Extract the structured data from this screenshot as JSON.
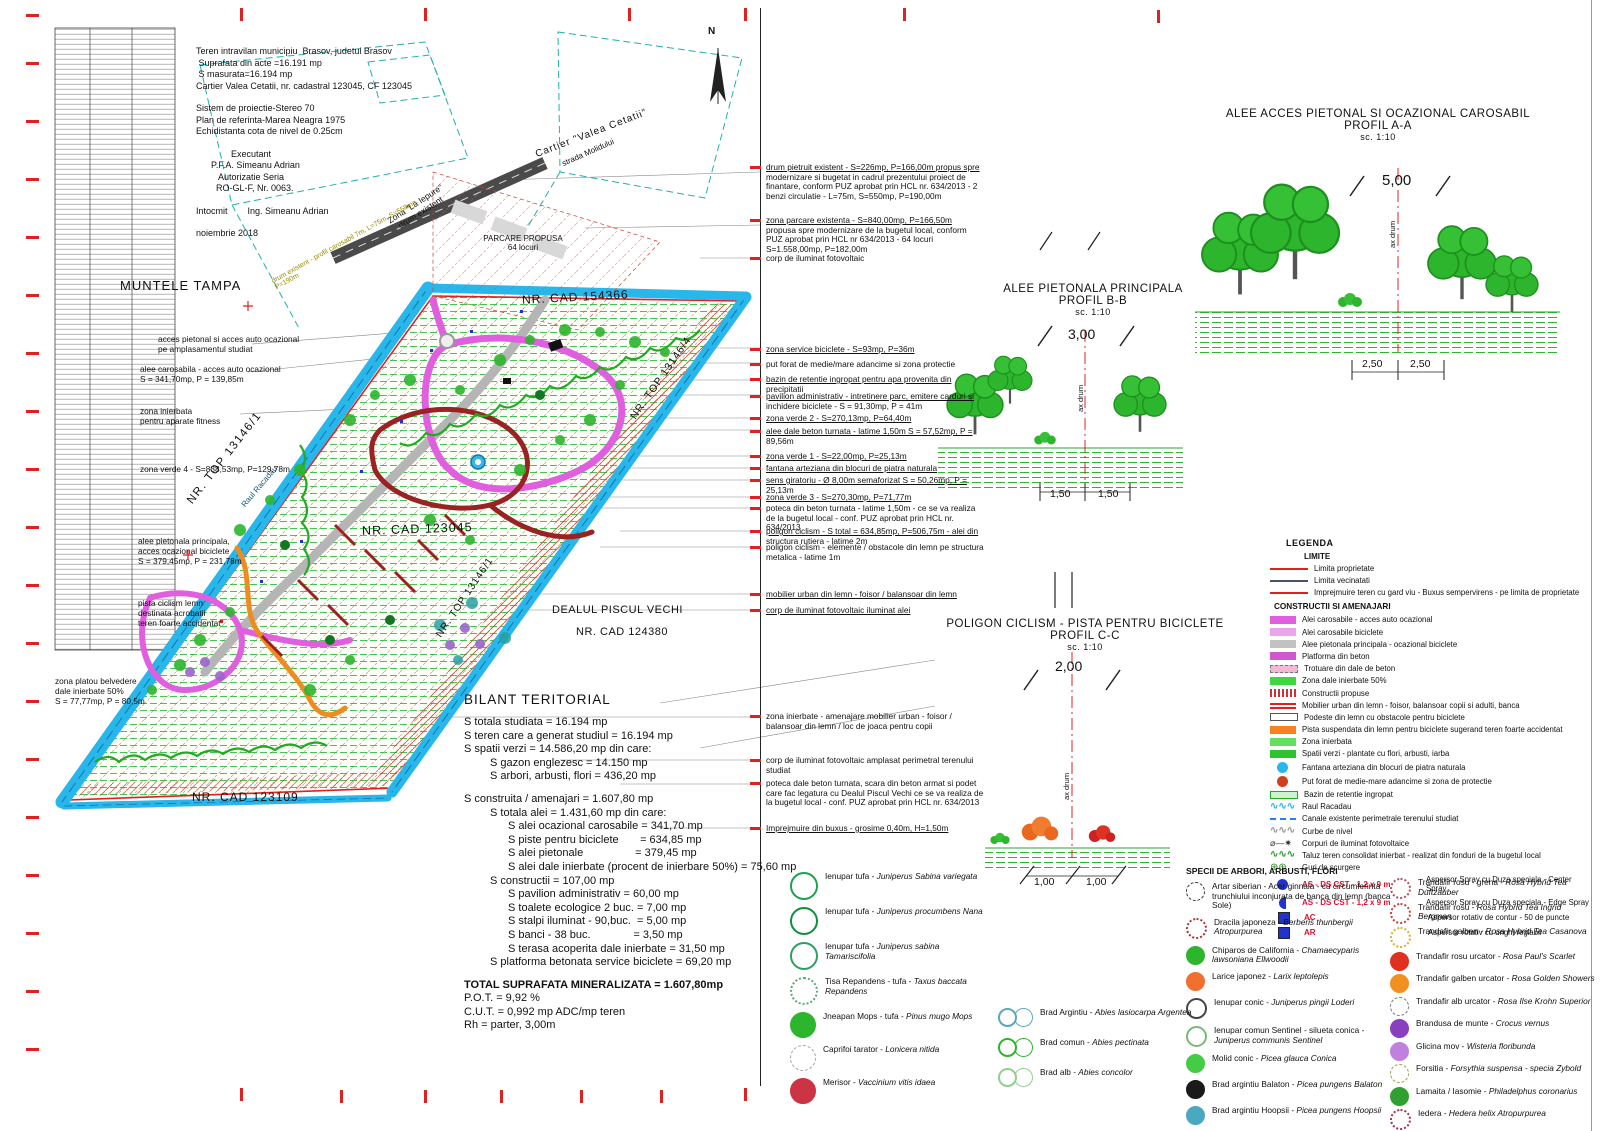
{
  "info_block": {
    "lines": [
      "Teren intravilan municipiu  Brasov, judetul Brasov",
      " Suprafata din acte =16.191 mp",
      " S masurata=16.194 mp",
      "Cartier Valea Cetatii, nr. cadastral 123045, CF 123045",
      "",
      "Sistem de proiectie-Stereo 70",
      "Plan de referinta-Marea Neagra 1975",
      "Echidistanta cota de nivel de 0.25cm",
      "",
      "              Executant",
      "      P.F.A. Simeanu Adrian",
      "         Autorizatie Seria",
      "        RO-GL-F, Nr. 0063.",
      "",
      "Intocmit        Ing. Simeanu Adrian",
      "",
      "noiembrie 2018"
    ]
  },
  "plan_labels": {
    "muntele_tampa": "MUNTELE TAMPA",
    "cartier": "Cartier \"Valea Cetatii\"",
    "strada": "strada Molidului",
    "zona_la_iepure": "Zona \"La Iepure\"\ndrum existent",
    "road_note": "drum existent - profil carosabil 7m, L=75m, S=550mp, P=190m",
    "parcare": "PARCARE PROPUSA\n64 locuri",
    "nr_cad_154366": "NR. CAD 154366",
    "nr_top_13146_4": "NR. TOP 13146/4",
    "nr_top_13146_1a": "NR. TOP 13146/1",
    "nr_top_13146_1b": "NR. TOP 13146/1",
    "nr_cad_123045": "NR. CAD 123045",
    "dealul_piscul_vechi": "DEALUL PISCUL VECHI",
    "nr_cad_124380": "NR. CAD 124380",
    "nr_cad_123109": "NR. CAD 123109",
    "raul_racadau": "Raul Racadau",
    "north": "N"
  },
  "left_labels": [
    {
      "t": "acces pietonal si acces auto ocazional\npe amplasamentul studiat"
    },
    {
      "t": "alee carosabila - acces auto ocazional\nS = 341,70mp, P = 139,85m"
    },
    {
      "t": "zona inierbata\npentru aparate fitness"
    },
    {
      "t": "zona verde 4 - S=838,53mp, P=129,78m"
    },
    {
      "t": "alee pietonala principala,\nacces ocazional biciclete\nS = 379,45mp, P = 231,78m"
    },
    {
      "t": "pista ciclism lemn\ndestinata acrobatii\nteren foarte accidentat"
    },
    {
      "t": "zona platou belvedere\ndale inierbate 50%\nS = 77,77mp, P = 80,5m"
    }
  ],
  "notes": [
    {
      "t": "drum pietruit existent - S=226mp, P=166,00m propus spre modernizare si bugetat in cadrul prezentului proiect de finantare, conform PUZ aprobat prin HCL nr. 634/2013 - 2 benzi circulatie - L=75m, S=550mp, P=190,00m"
    },
    {
      "t": "zona parcare existenta - S=840,00mp, P=166,50m propusa spre modernizare de la bugetul local, conform PUZ aprobat prin HCL nr 634/2013 - 64 locuri S=1.558,00mp, P=182,00m"
    },
    {
      "t": "corp de iluminat fotovoltaic"
    },
    {
      "t": "zona service biciclete - S=93mp, P=36m"
    },
    {
      "t": "put forat de medie/mare adancime si zona protectie"
    },
    {
      "t": "bazin de retentie ingropat pentru apa provenita din precipitatii"
    },
    {
      "t": "pavilion administrativ - intretinere parc, emitere carduri si inchidere biciclete - S = 91,30mp, P = 41m"
    },
    {
      "t": "zona verde 2 - S=270,13mp, P=64,40m"
    },
    {
      "t": "alee dale beton turnata - latime 1,50m S = 57,52mp, P = 89,56m"
    },
    {
      "t": "zona verde 1 - S=22,00mp, P=25,13m"
    },
    {
      "t": "fantana arteziana din blocuri de piatra naturala"
    },
    {
      "t": "sens giratoriu - Ø 8,00m semaforizat S = 50,26mp, P = 25,13m"
    },
    {
      "t": "zona verde 3 - S=270,30mp, P=71,77m"
    },
    {
      "t": "poteca din beton turnata - latime 1,50m - ce se va realiza de la bugetul local - conf. PUZ aprobat prin HCL nr. 634/2013"
    },
    {
      "t": "poligon ciclism - S total = 634,85mp, P=506,75m - alei din structura rutiera - latime 2m"
    },
    {
      "t": "poligon ciclism - elemente / obstacole din lemn pe structura metalica - latime 1m"
    },
    {
      "t": "mobilier urban din lemn - foisor / balansoar din lemn"
    },
    {
      "t": "corp de iluminat fotovoltaic iluminat alei"
    },
    {
      "t": "zona inierbate - amenajare mobilier urban - foisor / balansoar din lemn / loc de joaca pentru copii"
    },
    {
      "t": "corp de iluminat fotovoltaic amplasat perimetral terenului studiat"
    },
    {
      "t": "poteca dale beton turnata, scara din beton armat si podet care fac legatura cu Dealul Piscul Vechi ce se va realiza de la bugetul local - conf. PUZ aprobat prin HCL nr. 634/2013"
    },
    {
      "t": "Imprejmuire din buxus - grosime 0,40m, H=1,50m"
    }
  ],
  "bilant": {
    "title": "BILANT TERITORIAL",
    "lines": [
      {
        "cls": "i0",
        "t": "S totala studiata = 16.194 mp"
      },
      {
        "cls": "i0",
        "t": "S teren care a generat studiul = 16.194 mp"
      },
      {
        "cls": "i0",
        "t": "S spatii verzi = 14.586,20 mp din care:"
      },
      {
        "cls": "i1",
        "t": "S gazon englezesc = 14.150 mp"
      },
      {
        "cls": "i1",
        "t": "S arbori, arbusti, flori = 436,20 mp"
      },
      {
        "cls": "i0 gap",
        "t": "S construita / amenajari = 1.607,80 mp"
      },
      {
        "cls": "i1",
        "t": "S totala alei = 1.431,60 mp din care:"
      },
      {
        "cls": "i2",
        "t": "S alei ocazional carosabile = 341,70 mp"
      },
      {
        "cls": "i2",
        "t": "S piste pentru biciclete       = 634,85 mp"
      },
      {
        "cls": "i2",
        "t": "S alei pietonale                 = 379,45 mp"
      },
      {
        "cls": "i2",
        "t": "S alei dale inierbate (procent de inierbare 50%) = 75,60 mp"
      },
      {
        "cls": "i1",
        "t": "S constructii = 107,00 mp"
      },
      {
        "cls": "i2",
        "t": "S pavilion administrativ = 60,00 mp"
      },
      {
        "cls": "i2",
        "t": "S toalete ecologice 2 buc. = 7,00 mp"
      },
      {
        "cls": "i2",
        "t": "S stalpi iluminat - 90,buc.  = 5,00 mp"
      },
      {
        "cls": "i2",
        "t": "S banci - 38 buc.              = 3,50 mp"
      },
      {
        "cls": "i2",
        "t": "S terasa acoperita dale inierbate = 31,50 mp"
      },
      {
        "cls": "i1",
        "t": "S platforma betonata service biciclete = 69,20 mp"
      },
      {
        "cls": "i0 gap b",
        "t": "TOTAL SUPRAFATA MINERALIZATA = 1.607,80mp"
      },
      {
        "cls": "i0",
        "t": "P.O.T. = 9,92 %"
      },
      {
        "cls": "i0",
        "t": "C.U.T. = 0,992 mp ADC/mp teren"
      },
      {
        "cls": "i0",
        "t": "Rh = parter, 3,00m"
      }
    ]
  },
  "profiles": {
    "aa": {
      "title1": "ALEE ACCES PIETONAL SI OCAZIONAL CAROSABIL",
      "title2": "PROFIL A-A",
      "scale": "sc. 1:10",
      "dim_top": "5,00",
      "axis": "ax drum",
      "dim_left": "2,50",
      "dim_right": "2,50"
    },
    "bb": {
      "title1": "ALEE PIETONALA PRINCIPALA",
      "title2": "PROFIL B-B",
      "scale": "sc. 1:10",
      "dim_top": "3,00",
      "axis": "ax drum",
      "dim_left": "1,50",
      "dim_right": "1,50"
    },
    "cc": {
      "title1": "POLIGON CICLISM - PISTA PENTRU BICICLETE",
      "title2": "PROFIL C-C",
      "scale": "sc. 1:10",
      "dim_top": "2,00",
      "axis": "ax drum",
      "dim_left": "1,00",
      "dim_right": "1,00"
    }
  },
  "legend": {
    "title": "LEGENDA",
    "limite_title": "LIMITE",
    "limite": [
      {
        "k": "sw-line",
        "c": "#e02020",
        "label": "Limita proprietate"
      },
      {
        "k": "sw-line",
        "c": "#445566",
        "label": "Limita vecinatati"
      },
      {
        "k": "sw-line",
        "c": "#e02020",
        "label": "Imprejmuire teren cu gard viu - Buxus sempervirens - pe limita de proprietate"
      }
    ],
    "constructii_title": "CONSTRUCTII SI AMENAJARI",
    "items": [
      {
        "k": "sw-rect",
        "c": "#df5fdf",
        "code": "",
        "label": "Alei carosabile - acces auto ocazional"
      },
      {
        "k": "sw-rect",
        "c": "#eba6eb",
        "code": "",
        "label": "Alei carosabile biciclete"
      },
      {
        "k": "sw-rect",
        "c": "#c2c2c2",
        "code": "",
        "label": "Alee pietonala principala - ocazional biciclete"
      },
      {
        "k": "sw-rect",
        "c": "#cf58cf",
        "code": "",
        "label": "Platforma din beton"
      },
      {
        "k": "sw-rectd",
        "c": "#f2b9d5",
        "code": "",
        "label": "Trotuare din dale de beton"
      },
      {
        "k": "sw-rect",
        "c": "#3fd63f",
        "code": "",
        "label": "Zona dale inierbate 50%"
      },
      {
        "k": "sw-hatch",
        "c": "#d03030",
        "code": "",
        "label": "Constructii propuse"
      },
      {
        "k": "sw-bars",
        "c": "#e02020",
        "code": "",
        "label": "Mobilier urban din lemn - foisor, balansoar copii si adulti, banca"
      },
      {
        "k": "sw-outline",
        "c": "#ffffff",
        "code": "",
        "label": "Podeste din lemn cu obstacole pentru biciclete"
      },
      {
        "k": "sw-rect",
        "c": "#f5821f",
        "code": "",
        "label": "Pista suspendata din lemn pentru biciclete sugerand teren foarte accidentat"
      },
      {
        "k": "sw-rect",
        "c": "#62e062",
        "code": "",
        "label": "Zona inierbata"
      },
      {
        "k": "sw-rect",
        "c": "#2fc42f",
        "code": "",
        "label": "Spatii verzi - plantate cu flori, arbusti, iarba"
      },
      {
        "k": "sw-circle",
        "c": "#29b6ea",
        "code": "",
        "label": "Fantana arteziana din blocuri de piatra naturala"
      },
      {
        "k": "sw-circle",
        "c": "#d04020",
        "code": "",
        "label": "Put forat de medie-mare adancime si zona de protectie"
      },
      {
        "k": "sw-rectg",
        "c": "#2aa22a",
        "code": "",
        "label": "Bazin de retentie ingropat"
      },
      {
        "k": "sw-wave",
        "c": "#29b6ea",
        "code": "",
        "label": "Raul Racadau"
      },
      {
        "k": "sw-dashline",
        "c": "#2980ea",
        "code": "",
        "label": "Canale existente perimetrale terenului studiat"
      },
      {
        "k": "sw-wave",
        "c": "#999999",
        "code": "",
        "label": "Curbe de nivel"
      },
      {
        "k": "sw-light",
        "c": "#333333",
        "code": "",
        "label": "Corpuri de iluminat fotovoltaice"
      },
      {
        "k": "sw-wave",
        "c": "#2fa32f",
        "code": "",
        "label": "Taluz teren consolidat inierbat - realizat din fonduri de la bugetul local"
      },
      {
        "k": "sw-drain",
        "c": "#2a8a2a",
        "code": "",
        "label": "Guri de scurgere"
      },
      {
        "k": "sw-circle",
        "c": "#2233cc",
        "code": "AS - DS CST - 1,2 x 9 m",
        "label": "Aspersor Spray cu Duza speciala - Center Spray"
      },
      {
        "k": "sw-halfcircle",
        "c": "#2233cc",
        "code": "AS - DS CST - 1,2 x 9 m",
        "label": "Aspersor Spray cu Duza speciala - Edge Spray"
      },
      {
        "k": "sw-square",
        "c": "#2233cc",
        "code": "AC",
        "label": "Aspersor rotativ de contur - 50 de puncte"
      },
      {
        "k": "sw-square",
        "c": "#2233cc",
        "code": "AR",
        "label": "Aspersor rotativ cu unghi reglabil"
      }
    ]
  },
  "species": {
    "title": "SPECII DE ARBORI, ARBUSTI, FLORI",
    "shrubs_left": [
      {
        "g": "g-outline",
        "c": "#1f9f4f",
        "name": "Ienupar tufa -",
        "latin": "Juniperus Sabina variegata"
      },
      {
        "g": "g-outline",
        "c": "#0f8f3f",
        "name": "Ienupar tufa -",
        "latin": "Juniperus procumbens Nana"
      },
      {
        "g": "g-outline",
        "c": "#2f9f5f",
        "name": "Ienupar tufa -",
        "latin": "Juniperus sabina Tamariscifolia"
      },
      {
        "g": "g-dotted",
        "c": "#55aa77",
        "name": "Tisa Repandens - tufa -",
        "latin": "Taxus baccata Repandens"
      },
      {
        "g": "g-solid",
        "c": "#2db52d",
        "name": "Jneapan Mops - tufa -",
        "latin": "Pinus mugo Mops"
      },
      {
        "g": "g-sketch",
        "c": "#9aa89a",
        "name": "Caprifoi tarator -",
        "latin": "Lonicera nitida"
      },
      {
        "g": "g-solid",
        "c": "#cc3344",
        "name": "Merisor -",
        "latin": "Vaccinium vitis idaea"
      }
    ],
    "trees_main": [
      {
        "g": "g-sketch",
        "c": "#333333",
        "name": "Artar siberian - Acer ginnala - cu circumferinta trunchiului inconjurata de banca din lemn (banca Sole)",
        "latin": ""
      },
      {
        "g": "g-dotted",
        "c": "#aa3333",
        "name": "Dracila japoneza -",
        "latin": "Berberis thunbergii Atropurpurea"
      },
      {
        "g": "g-solid",
        "c": "#2db52d",
        "name": "Chiparos de California -",
        "latin": "Chamaecyparis lawsoniana Ellwoodii"
      },
      {
        "g": "g-solid",
        "c": "#f07030",
        "name": "Larice japonez -",
        "latin": "Larix leptolepis"
      },
      {
        "g": "g-outline",
        "c": "#444444",
        "name": "Ienupar conic -",
        "latin": "Juniperus pingii Loderi"
      },
      {
        "g": "g-outline",
        "c": "#7ab87a",
        "name": "Ienupar comun Sentinel - silueta conica -",
        "latin": "Juniperus communis Sentinel"
      },
      {
        "g": "g-solid",
        "c": "#45cc45",
        "name": "Molid conic -",
        "latin": "Picea glauca Conica"
      },
      {
        "g": "g-solid",
        "c": "#1a1a1a",
        "name": "Brad argintiu Balaton -",
        "latin": "Picea pungens Balaton"
      },
      {
        "g": "g-solid",
        "c": "#4aa8c0",
        "name": "Brad argintiu Hoopsii -",
        "latin": "Picea pungens Hoopsii"
      }
    ],
    "flowers_right": [
      {
        "g": "g-dotted",
        "c": "#b05060",
        "name": "Trandafir rosu - grena -",
        "latin": "Rosa Hybrid Tea Duftzauber"
      },
      {
        "g": "g-dotted",
        "c": "#c04040",
        "name": "Trandafir rosu -",
        "latin": "Rosa Hybrid Tea Ingrid Bergman"
      },
      {
        "g": "g-dotted",
        "c": "#d8b030",
        "name": "Trandafir galben -",
        "latin": "Rosa Hybrid Tea Casanova"
      },
      {
        "g": "g-solid",
        "c": "#e03020",
        "name": "Trandafir rosu urcator -",
        "latin": "Rosa Paul's Scarlet"
      },
      {
        "g": "g-solid",
        "c": "#f09020",
        "name": "Trandafir galben urcator -",
        "latin": "Rosa Golden Showers"
      },
      {
        "g": "g-sketch",
        "c": "#777777",
        "name": "Trandafir alb urcator -",
        "latin": "Rosa Ilse Krohn Superior"
      },
      {
        "g": "g-solid",
        "c": "#8840c0",
        "name": "Brandusa de munte -",
        "latin": "Crocus vernus"
      },
      {
        "g": "g-solid",
        "c": "#c080e0",
        "name": "Glicina mov -",
        "latin": "Wisteria floribunda"
      },
      {
        "g": "g-sketch",
        "c": "#a0a040",
        "name": "Forsitia -",
        "latin": "Forsythia suspensa - specia Zybold"
      },
      {
        "g": "g-solid",
        "c": "#30a030",
        "name": "Lamaita / Iasomie -",
        "latin": "Philadelphus coronarius"
      },
      {
        "g": "g-dotted",
        "c": "#a03050",
        "name": "Iedera -",
        "latin": "Hedera helix Atropurpurea"
      }
    ],
    "firs_center": [
      {
        "g": "g-outline",
        "c": "#5aa8b8",
        "name": "Brad Argintiu -",
        "latin": "Abies lasiocarpa Argentea"
      },
      {
        "g": "g-outline",
        "c": "#2db52d",
        "name": "Brad comun -",
        "latin": "Abies pectinata"
      },
      {
        "g": "g-outline",
        "c": "#8fcf8f",
        "name": "Brad alb -",
        "latin": "Abies concolor"
      }
    ]
  }
}
